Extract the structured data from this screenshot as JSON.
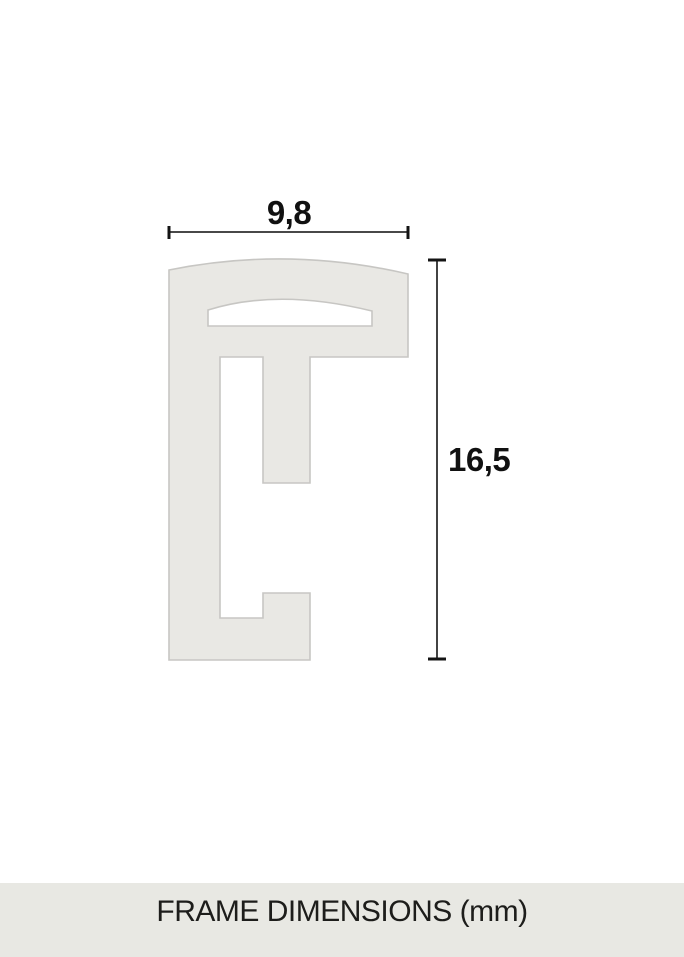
{
  "diagram": {
    "width_label": "9,8",
    "height_label": "16,5",
    "unit": "mm"
  },
  "footer": {
    "label": "FRAME DIMENSIONS (mm)"
  },
  "colors": {
    "background": "#ffffff",
    "profile_fill": "#e9e8e4",
    "profile_stroke": "#c7c6c3",
    "dimension_line": "#2e2e2e",
    "dimension_text": "#111111",
    "footer_background": "#e8e8e3",
    "footer_text": "#1d1d1b"
  }
}
